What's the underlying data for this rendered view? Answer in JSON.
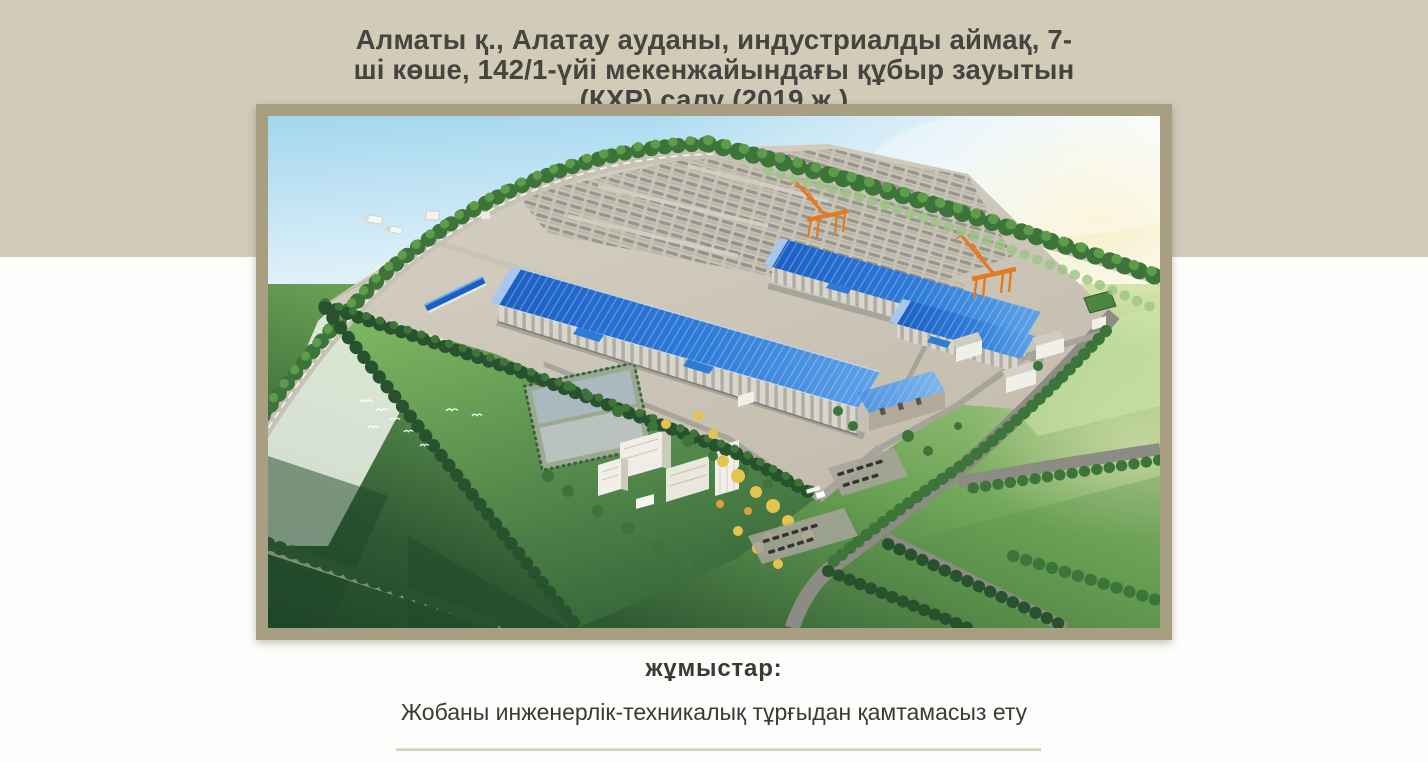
{
  "theme": {
    "page": "#fdfdfc",
    "beige": "#d1cbb8",
    "frame": "#a89e82",
    "title": "#454440",
    "text": "#3b3a35",
    "divider": "#cdc8b8",
    "dividerHi": "#e2ded2",
    "sky1": "#a3d6ee",
    "sky2": "#d8eef8",
    "glow": "#f7efc7",
    "fieldLight": "#c2dd9d",
    "fieldMid": "#6ca355",
    "fieldDark": "#2e5a33",
    "fieldDeep": "#1e4527",
    "lawn1": "#7cb561",
    "lawn2": "#35663a",
    "haze": "#f1f6ec",
    "pad1": "#d7d1c5",
    "pad2": "#c4bdae",
    "roof1": "#1b5ec4",
    "roof2": "#2f7cd8",
    "roof3": "#5ea2e8",
    "roofPale": "#8fc0f0",
    "gable": "#a8c6ee",
    "wall": "#d9d6cd",
    "wallShade": "#b3a99b",
    "road": "#8d8c84",
    "roadLight": "#a7a49b",
    "roadPale": "#c6c2b4",
    "treeDark": "#28522e",
    "treeMid": "#3c7439",
    "treeLight": "#5d9c4b",
    "treePale": "#9cc483",
    "treeYellow": "#e4c44e",
    "treeOrange": "#d9a23b",
    "pond1": "#b9c2bf",
    "pond2": "#aab9bd",
    "crane": "#e5791f",
    "whiteBld": "#f0efe8",
    "car": "#35342e"
  },
  "header": {
    "title": "Алматы қ., Алатау ауданы, индустриалды аймақ, 7-\nші көше, 142/1-үйі мекенжайындағы құбыр зауытын\n(ҚХР) салу (2019 ж.)"
  },
  "section": {
    "label": "жұмыстар:",
    "description": "Жобаны инженерлік-техникалық тұрғыдан қамтамасыз ету"
  }
}
